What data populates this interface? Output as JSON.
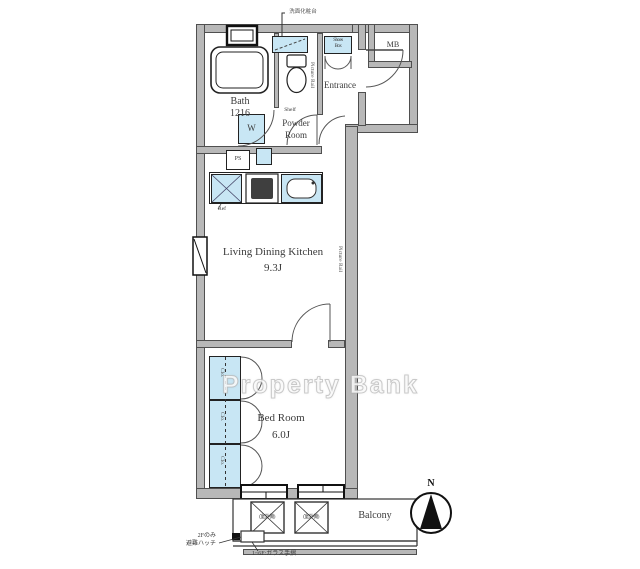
{
  "watermark": "Property Bank",
  "compass": {
    "north": "N"
  },
  "rooms": {
    "bath": {
      "name": "Bath",
      "size": "1216"
    },
    "powder": {
      "line1": "Powder",
      "line2": "Room"
    },
    "entrance": {
      "name": "Entrance"
    },
    "mb": {
      "name": "MB"
    },
    "ldk": {
      "name": "Living Dining Kitchen",
      "size": "9.3J"
    },
    "bedroom": {
      "name": "Bed Room",
      "size": "6.0J"
    },
    "balcony": {
      "name": "Balcony"
    }
  },
  "fixtures": {
    "washer": "W",
    "shelf": "Shelf",
    "ps": "PS",
    "fridge": "Ref",
    "shoes_box_line1": "Shoes",
    "shoes_box_line2": "Box",
    "closet": "Clo.",
    "ac_unit": "(室外機)",
    "picture_rail": "Picture Rail",
    "vanity_callout": "洗面化粧台"
  },
  "annotations": {
    "hatch_floor": "2Fのみ",
    "hatch_name": "避難ハッチ",
    "railing": "1~6F:ガラス手摺"
  },
  "colors": {
    "wall": "#b8b8b8",
    "fixture": "#c8e6f4",
    "outline": "#2b2b2b"
  }
}
